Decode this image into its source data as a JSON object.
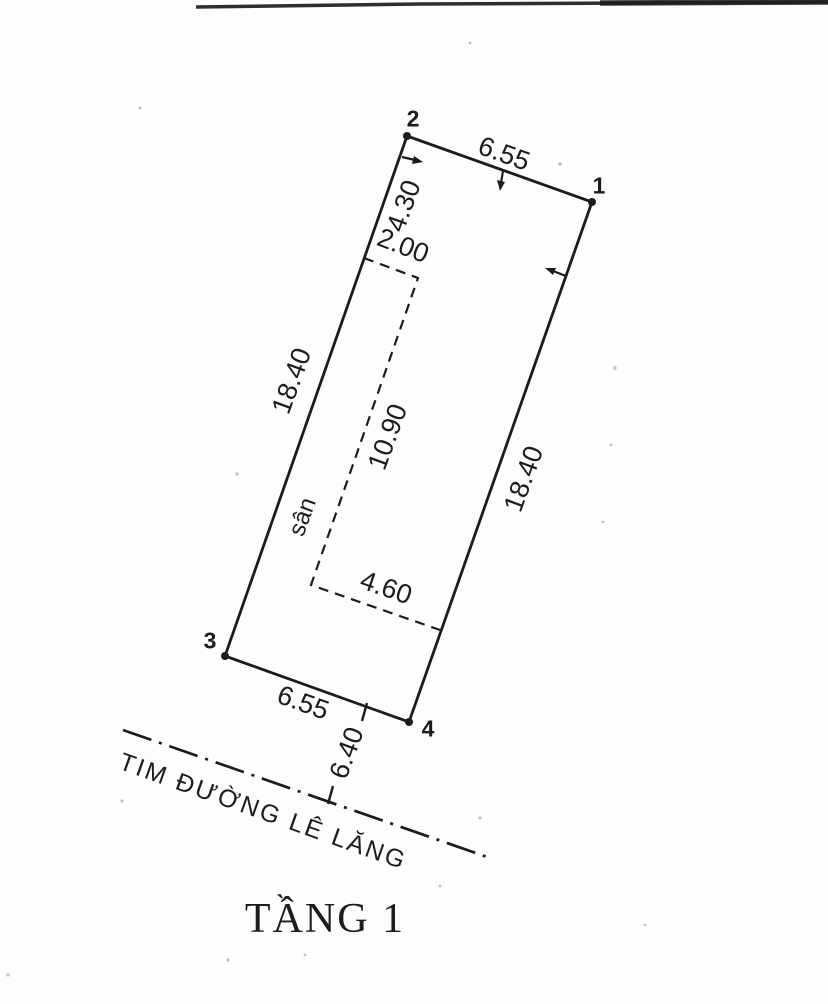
{
  "drawing": {
    "title": "TẦNG 1",
    "road_label": "TIM ĐƯỜNG LÊ LĂNG",
    "yard_label": "sân",
    "corners": {
      "p1": "1",
      "p2": "2",
      "p3": "3",
      "p4": "4"
    },
    "dimensions": {
      "top_edge": "6.55",
      "left_offset": "4.30",
      "yard_width": "2.00",
      "left_edge": "18.40",
      "yard_length": "10.90",
      "right_edge": "18.40",
      "yard_bottom": "4.60",
      "bottom_edge": "6.55",
      "road_setback": "6.40"
    },
    "ink_color": "#1c1c1c",
    "paper_color": "#fdfdfc"
  }
}
